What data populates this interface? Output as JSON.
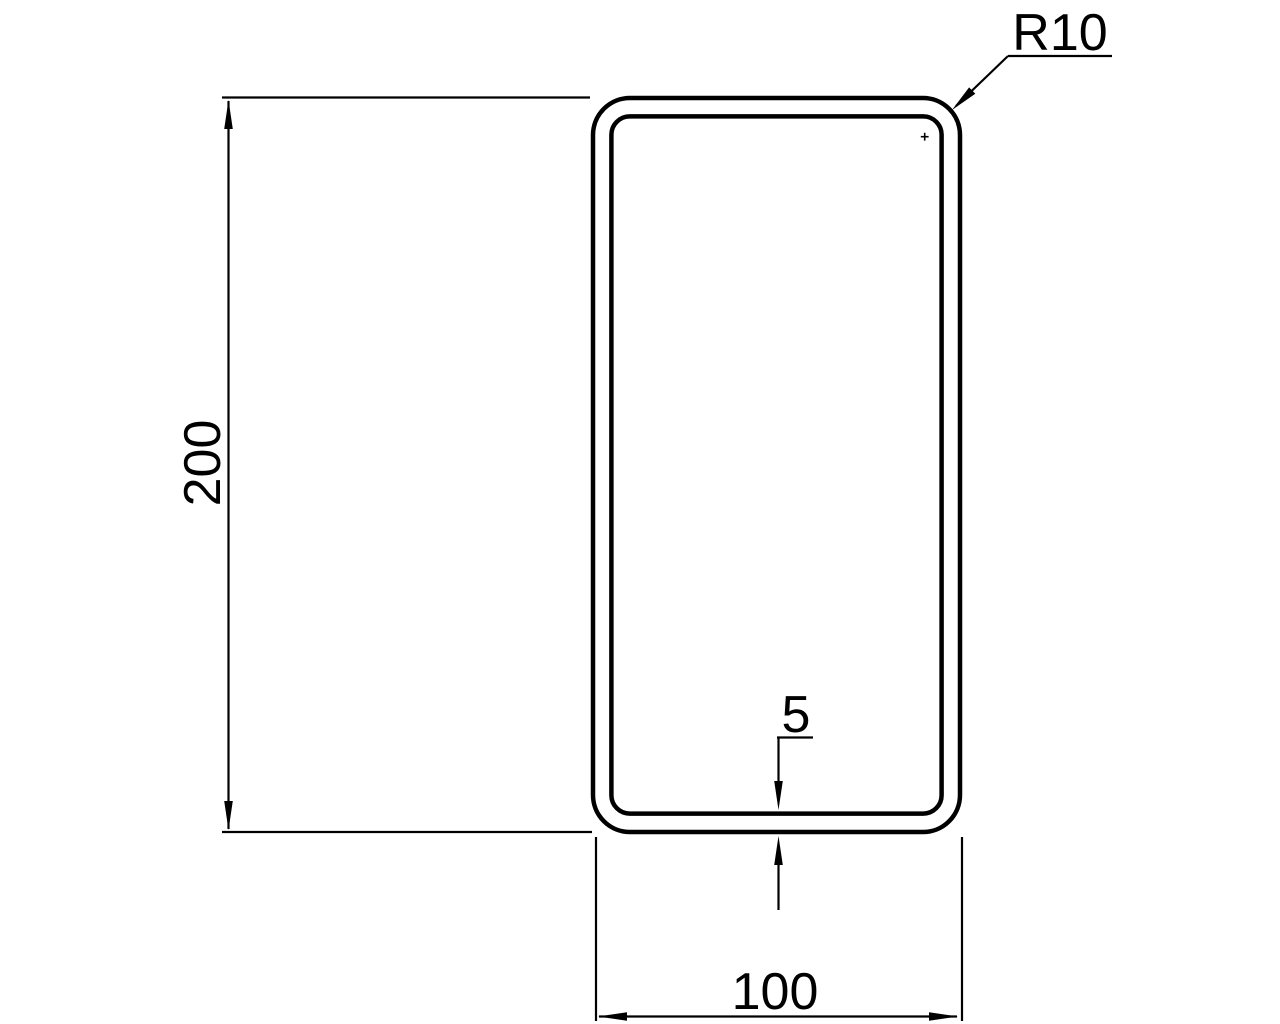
{
  "drawing": {
    "type": "technical-cross-section",
    "colors": {
      "background": "#ffffff",
      "line": "#000000"
    },
    "labels": {
      "height": "200",
      "width": "100",
      "wall_thickness": "5",
      "corner_radius": "R10"
    }
  }
}
